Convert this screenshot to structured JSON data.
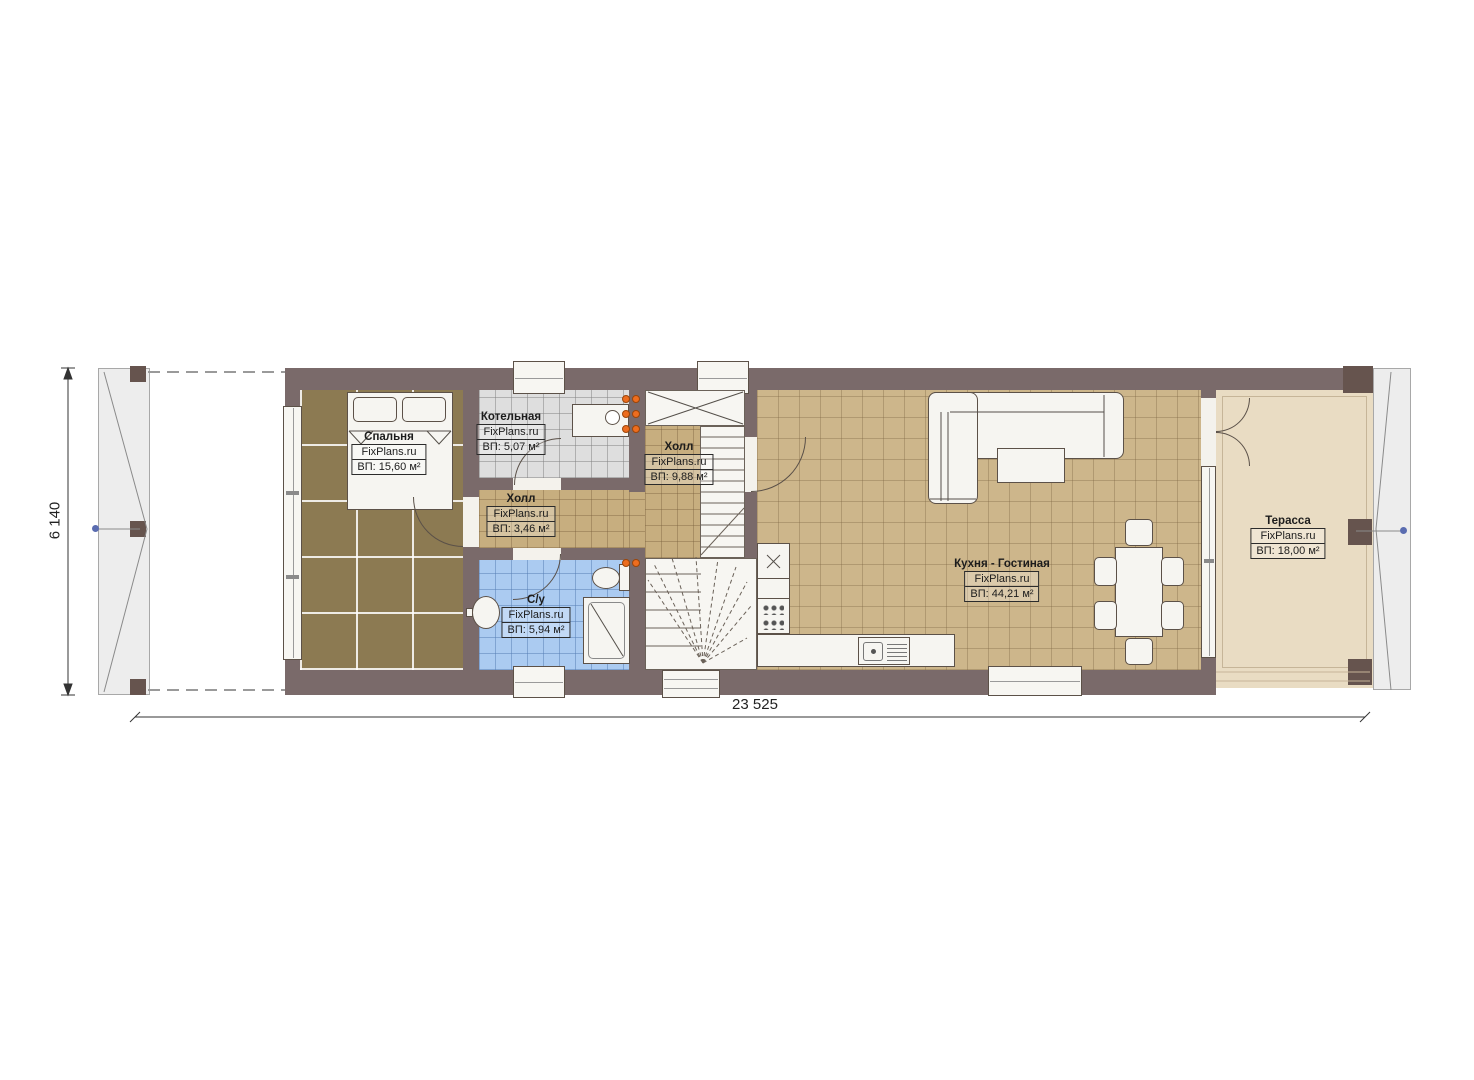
{
  "plan": {
    "site_watermark": "FixPlans.ru",
    "type": "floor-plan"
  },
  "rooms": [
    {
      "name": "Спальня",
      "brand": "FixPlans.ru",
      "area": "ВП: 15,60 м²"
    },
    {
      "name": "Котельная",
      "brand": "FixPlans.ru",
      "area": "ВП: 5,07 м²"
    },
    {
      "name": "Холл",
      "brand": "FixPlans.ru",
      "area": "ВП: 3,46 м²"
    },
    {
      "name": "Холл",
      "brand": "FixPlans.ru",
      "area": "ВП: 9,88 м²"
    },
    {
      "name": "С/у",
      "brand": "FixPlans.ru",
      "area": "ВП: 5,94 м²"
    },
    {
      "name": "Кухня - Гостиная",
      "brand": "FixPlans.ru",
      "area": "ВП: 44,21 м²"
    },
    {
      "name": "Терасса",
      "brand": "FixPlans.ru",
      "area": "ВП: 18,00 м²"
    }
  ],
  "dimensions": {
    "bottom": "23 525",
    "left": "6 140"
  },
  "colors": {
    "wall": "#7a6a6a",
    "wood_floor": "#8c7a52",
    "tile_tan": "#cdb68b",
    "tile_gray": "#dedede",
    "tile_blue": "#abcbf1",
    "terrace": "#e9dcc3",
    "radiator": "#ed6d1f",
    "axis_marker": "#5a6cb0"
  }
}
